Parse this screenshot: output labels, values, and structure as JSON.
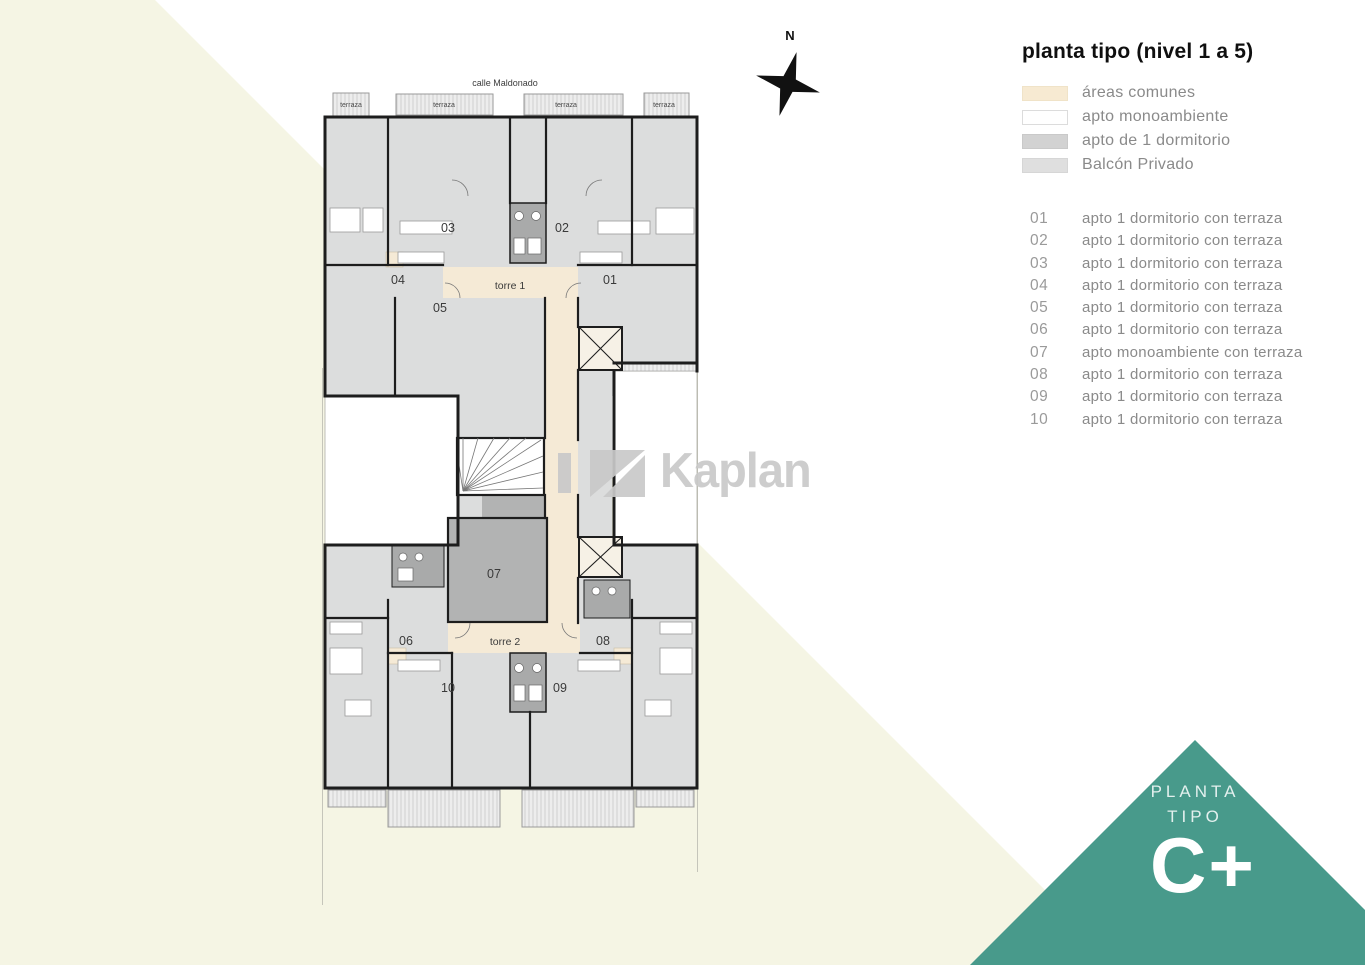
{
  "panel": {
    "title": "planta tipo (nivel 1 a 5)",
    "legend": [
      {
        "label": "áreas comunes",
        "color": "#f7ead2",
        "border": "#f0e3c8"
      },
      {
        "label": "apto monoambiente",
        "color": "#ffffff",
        "border": "#dcdcdc"
      },
      {
        "label": "apto de 1 dormitorio",
        "color": "#d2d2d2",
        "border": "#c9c9c9"
      },
      {
        "label": "Balcón Privado",
        "color": "#dfdfdf",
        "border": "#d6d6d6"
      }
    ],
    "units": [
      {
        "num": "01",
        "desc": "apto 1 dormitorio con terraza"
      },
      {
        "num": "02",
        "desc": "apto 1 dormitorio con terraza"
      },
      {
        "num": "03",
        "desc": "apto 1 dormitorio con terraza"
      },
      {
        "num": "04",
        "desc": "apto 1 dormitorio con terraza"
      },
      {
        "num": "05",
        "desc": "apto 1 dormitorio con terraza"
      },
      {
        "num": "06",
        "desc": "apto 1 dormitorio con terraza"
      },
      {
        "num": "07",
        "desc": "apto monoambiente con terraza"
      },
      {
        "num": "08",
        "desc": "apto 1 dormitorio con terraza"
      },
      {
        "num": "09",
        "desc": "apto 1 dormitorio con terraza"
      },
      {
        "num": "10",
        "desc": "apto 1 dormitorio con terraza"
      }
    ]
  },
  "plan": {
    "street": "calle Maldonado",
    "terrazas": [
      "terraza",
      "terraza",
      "terraza",
      "terraza"
    ],
    "torre1": "torre 1",
    "torre2": "torre 2"
  },
  "compass": {
    "label": "N"
  },
  "watermark": {
    "text": "Kaplan"
  },
  "badge": {
    "line1": "PLANTA",
    "line2": "TIPO",
    "big": "C+",
    "color": "#489a8b"
  }
}
